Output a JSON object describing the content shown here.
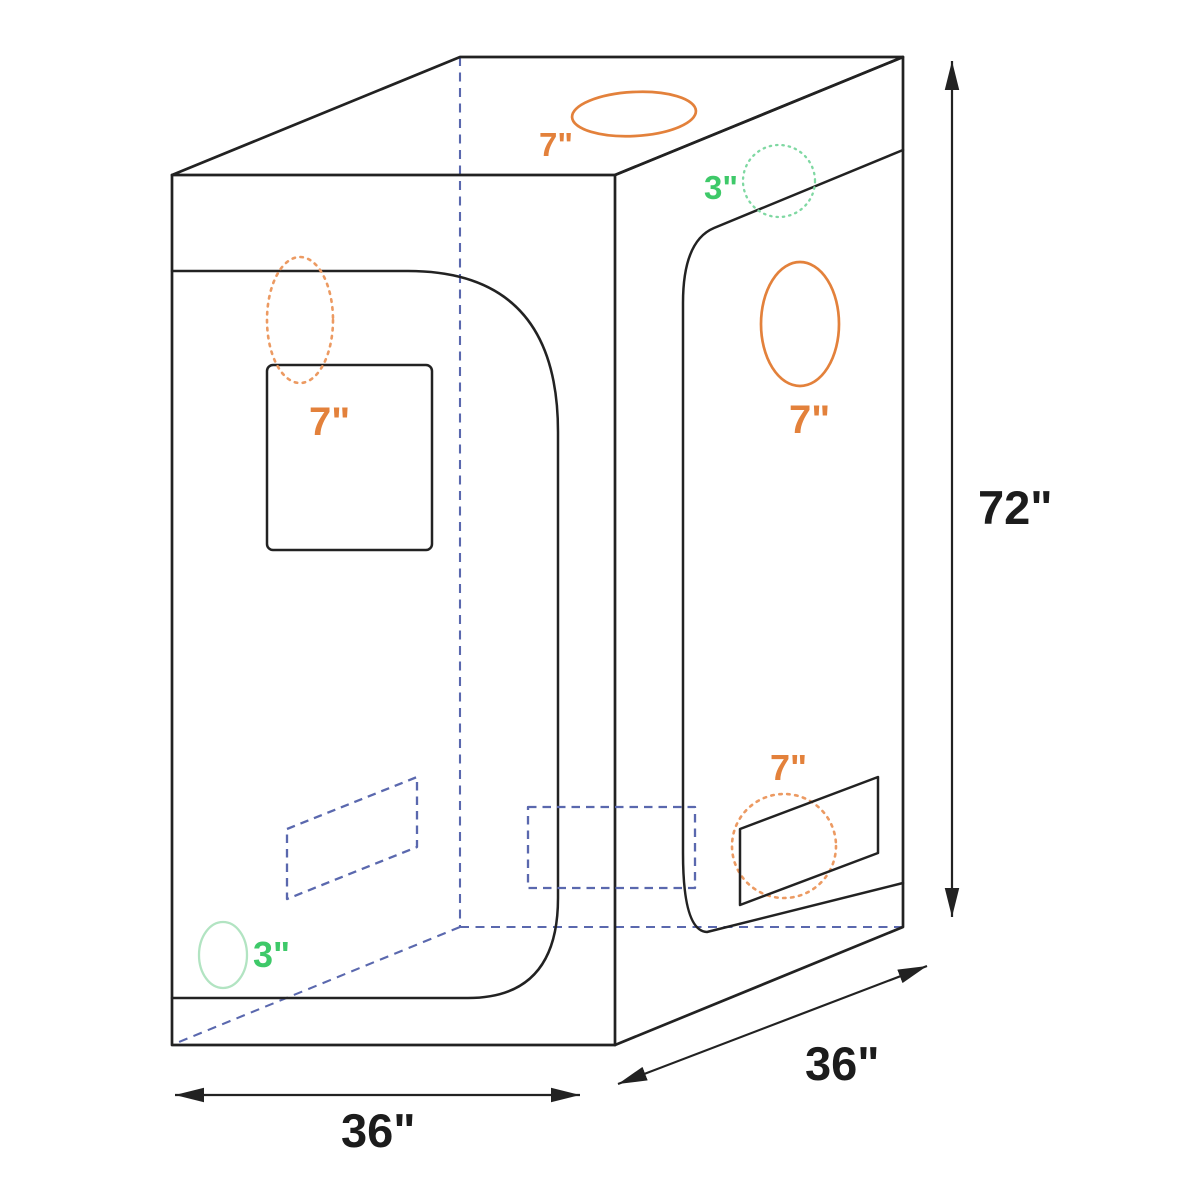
{
  "diagram": {
    "title": "Grow tent dimension diagram",
    "background": "#ffffff"
  },
  "dimensions": {
    "height": "72\"",
    "width": "36\"",
    "depth": "36\""
  },
  "ports": {
    "top_duct": "7\"",
    "front_duct": "7\"",
    "side_duct": "7\"",
    "rear_duct": "7\"",
    "top_side_vent": "3\"",
    "bottom_left_vent": "3\""
  },
  "colors": {
    "line_black": "#222222",
    "label_black": "#1c1c1c",
    "duct_orange": "#e3813b",
    "duct_orange_light": "#ec9a62",
    "vent_green": "#3ec969",
    "vent_green_dotted": "#7fd8a2",
    "vent_green_light": "#b2e4c2",
    "hidden_blue": "#5a68ae"
  }
}
